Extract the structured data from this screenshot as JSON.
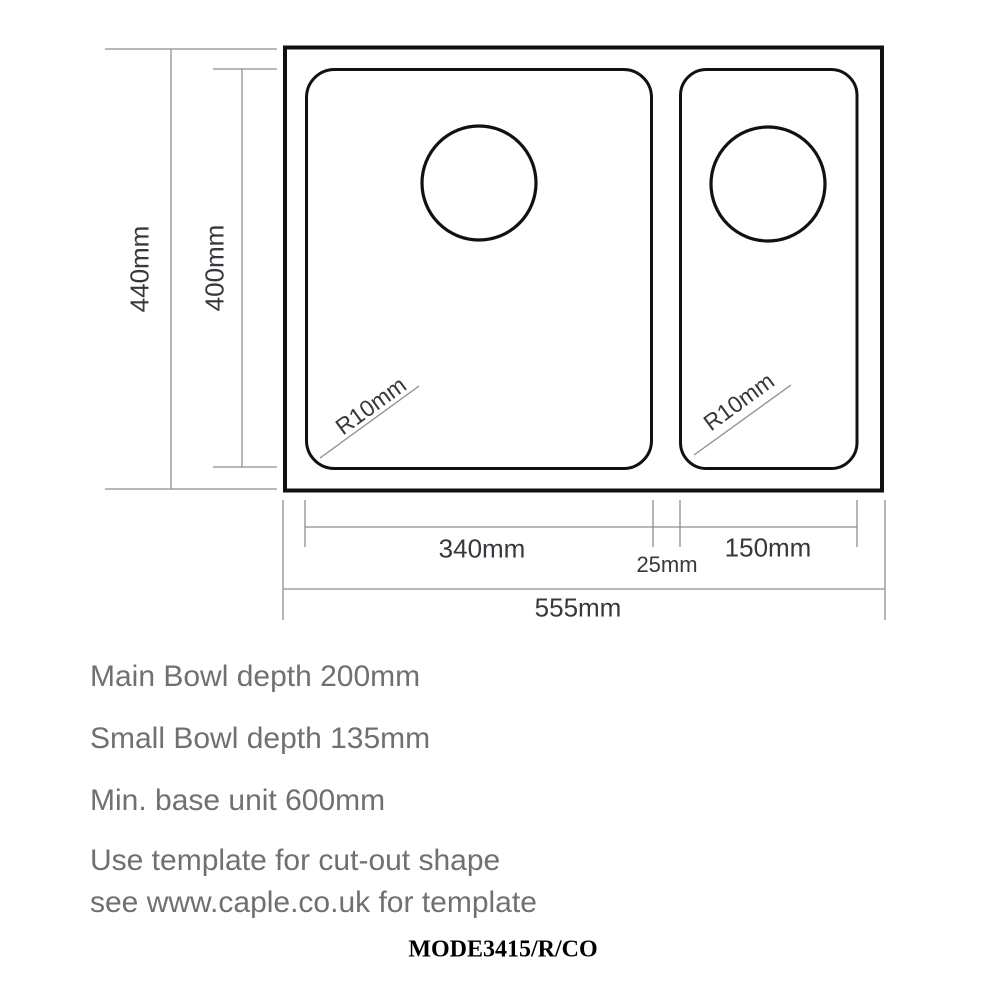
{
  "dimensions": {
    "overall_depth": "440mm",
    "bowl_depth": "400mm",
    "main_bowl_width": "340mm",
    "bowl_gap": "25mm",
    "small_bowl_width": "150mm",
    "overall_width": "555mm",
    "main_bowl_corner_radius": "R10mm",
    "small_bowl_corner_radius": "R10mm"
  },
  "notes": {
    "main_bowl_depth": "Main Bowl depth 200mm",
    "small_bowl_depth": "Small Bowl depth 135mm",
    "min_base_unit": "Min. base unit 600mm",
    "template_line_1": "Use template for cut-out shape",
    "template_line_2": "see www.caple.co.uk for template"
  },
  "footer": {
    "model_code": "MODE3415/R/CO"
  },
  "colors": {
    "outline": "#111111",
    "dimension_line": "#8e8e8e",
    "dimension_text": "#35383c",
    "note_text": "#6e7174"
  }
}
